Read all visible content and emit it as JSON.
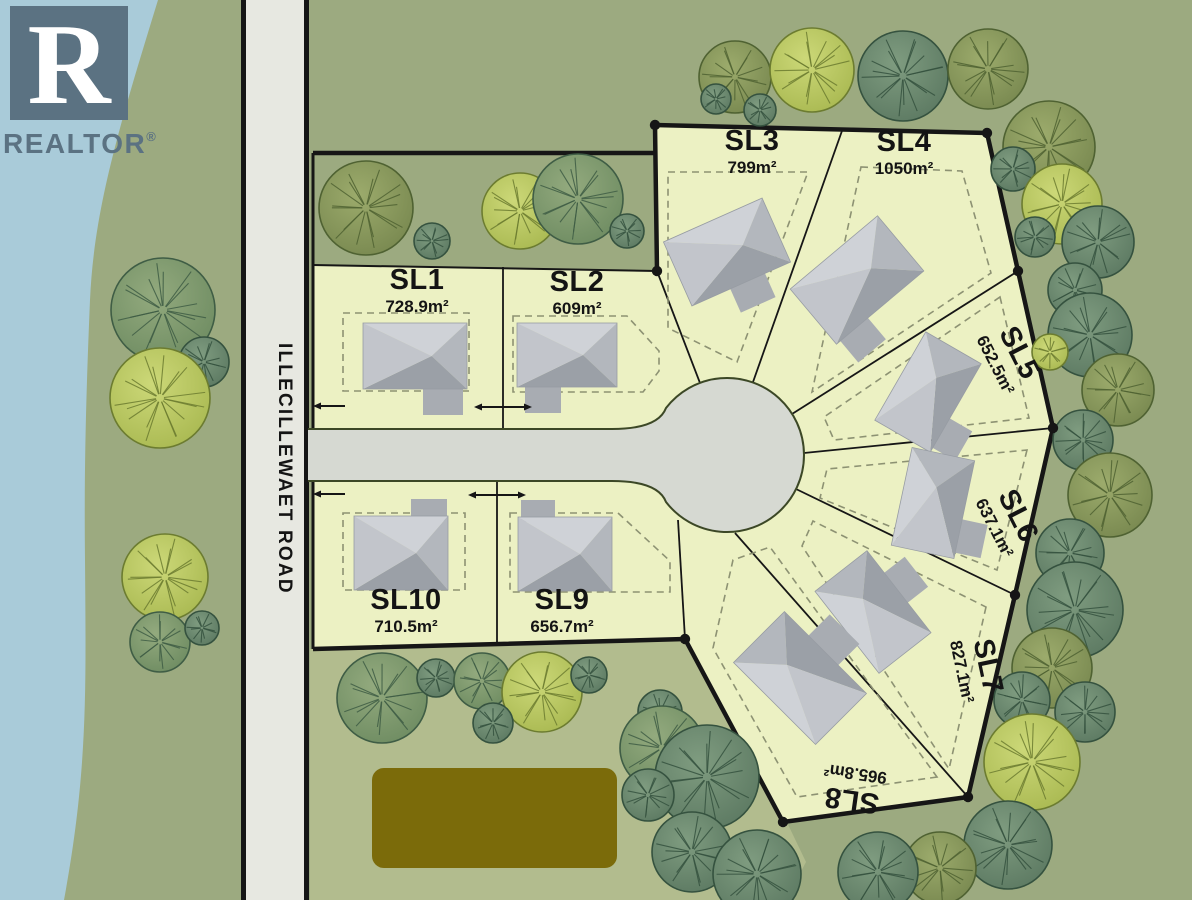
{
  "branding": {
    "letter": "R",
    "name": "REALTOR",
    "mark": "®"
  },
  "road": {
    "name": "ILLECILLEWAET ROAD"
  },
  "site": {
    "lots": [
      {
        "id": "SL1",
        "area": "728.9m²"
      },
      {
        "id": "SL2",
        "area": "609m²"
      },
      {
        "id": "SL3",
        "area": "799m²"
      },
      {
        "id": "SL4",
        "area": "1050m²"
      },
      {
        "id": "SL5",
        "area": "652.5m²"
      },
      {
        "id": "SL6",
        "area": "637.1m²"
      },
      {
        "id": "SL7",
        "area": "827.1m²"
      },
      {
        "id": "SL8",
        "area": "965.8m²"
      },
      {
        "id": "SL9",
        "area": "656.7m²"
      },
      {
        "id": "SL10",
        "area": "710.5m²"
      }
    ]
  },
  "colors": {
    "water": "#a9cbd9",
    "grass": "#9caa80",
    "grass_light": "#b2bc8e",
    "lot_fill": "#ecf1c3",
    "road_surface": "#e7e8e1",
    "road_edge": "#151515",
    "culdesac_surface": "#d6d9d2",
    "culdesac_edge": "#3c4826",
    "boundary": "#161616",
    "dashed_setback": "#8d9273",
    "pond": "#7b6b0a",
    "label": "#141414",
    "logo": "#5b7282",
    "house_light": "#cfd2d7",
    "house_mid": "#b3b7bd",
    "house_dark": "#9ba0a7",
    "house_west": "#c2c5cb",
    "house_wing": "#a8acb2"
  }
}
